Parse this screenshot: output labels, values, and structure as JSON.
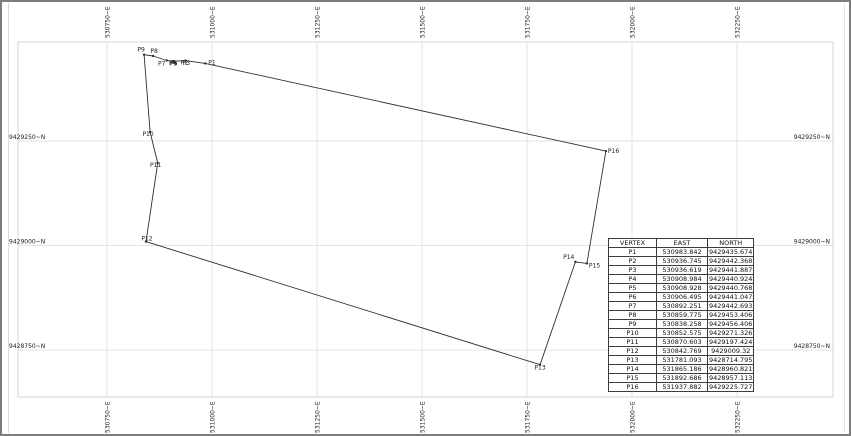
{
  "colors": {
    "border": "#7d7d7d",
    "frame": "#d4d4d4",
    "gridline": "#e3e3e3",
    "parcel_line": "#2f2f2f",
    "label_text": "#1c1c1c"
  },
  "drawing": {
    "grid": {
      "eastings": [
        {
          "value": 530750,
          "label": "530750~E"
        },
        {
          "value": 531000,
          "label": "531000~E"
        },
        {
          "value": 531250,
          "label": "531250~E"
        },
        {
          "value": 531500,
          "label": "531500~E"
        },
        {
          "value": 531750,
          "label": "531750~E"
        },
        {
          "value": 532000,
          "label": "532000~E"
        },
        {
          "value": 532250,
          "label": "532250~E"
        }
      ],
      "northings": [
        {
          "value": 9429250,
          "label": "9429250~N"
        },
        {
          "value": 9429000,
          "label": "9429000~N"
        },
        {
          "value": 9428750,
          "label": "9428750~N"
        }
      ]
    },
    "vertex_table": {
      "headers": [
        "VERTEX",
        "EAST",
        "NORTH"
      ],
      "rows": [
        {
          "vertex": "P1",
          "east": "530983.842",
          "north": "9429435.674"
        },
        {
          "vertex": "P2",
          "east": "530936.745",
          "north": "9429442.368"
        },
        {
          "vertex": "P3",
          "east": "530936.619",
          "north": "9429441.887"
        },
        {
          "vertex": "P4",
          "east": "530908.984",
          "north": "9429440.924"
        },
        {
          "vertex": "P5",
          "east": "530908.928",
          "north": "9429440.768"
        },
        {
          "vertex": "P6",
          "east": "530906.495",
          "north": "9429441.047"
        },
        {
          "vertex": "P7",
          "east": "530892.251",
          "north": "9429442.693"
        },
        {
          "vertex": "P8",
          "east": "530859.775",
          "north": "9429453.406"
        },
        {
          "vertex": "P9",
          "east": "530838.258",
          "north": "9429456.406"
        },
        {
          "vertex": "P10",
          "east": "530852.575",
          "north": "9429271.326"
        },
        {
          "vertex": "P11",
          "east": "530870.603",
          "north": "9429197.424"
        },
        {
          "vertex": "P12",
          "east": "530842.769",
          "north": "9429009.32"
        },
        {
          "vertex": "P13",
          "east": "531781.093",
          "north": "9428714.795"
        },
        {
          "vertex": "P14",
          "east": "531865.186",
          "north": "9428960.821"
        },
        {
          "vertex": "P15",
          "east": "531892.686",
          "north": "9428957.113"
        },
        {
          "vertex": "P16",
          "east": "531937.882",
          "north": "9429225.727"
        }
      ]
    }
  }
}
